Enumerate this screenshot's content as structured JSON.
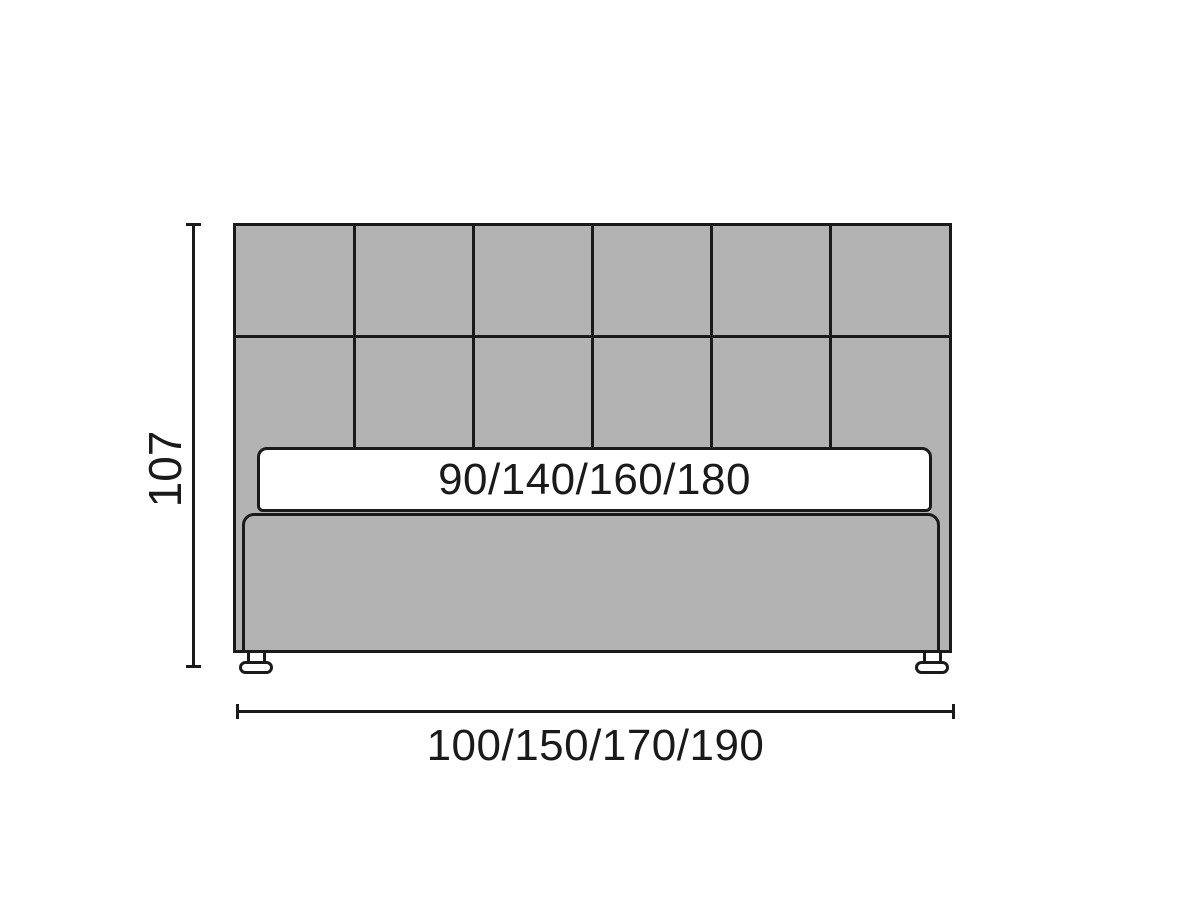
{
  "diagram": {
    "type": "furniture-dimension-diagram",
    "labels": {
      "height": "107",
      "mattress_widths": "90/140/160/180",
      "overall_widths": "100/150/170/190"
    },
    "headboard_grid": {
      "columns": 6,
      "rows": 2
    },
    "colors": {
      "panel_fill": "#b3b3b3",
      "line": "#1a1a1a",
      "mattress_fill": "#ffffff",
      "background": "#ffffff"
    }
  }
}
